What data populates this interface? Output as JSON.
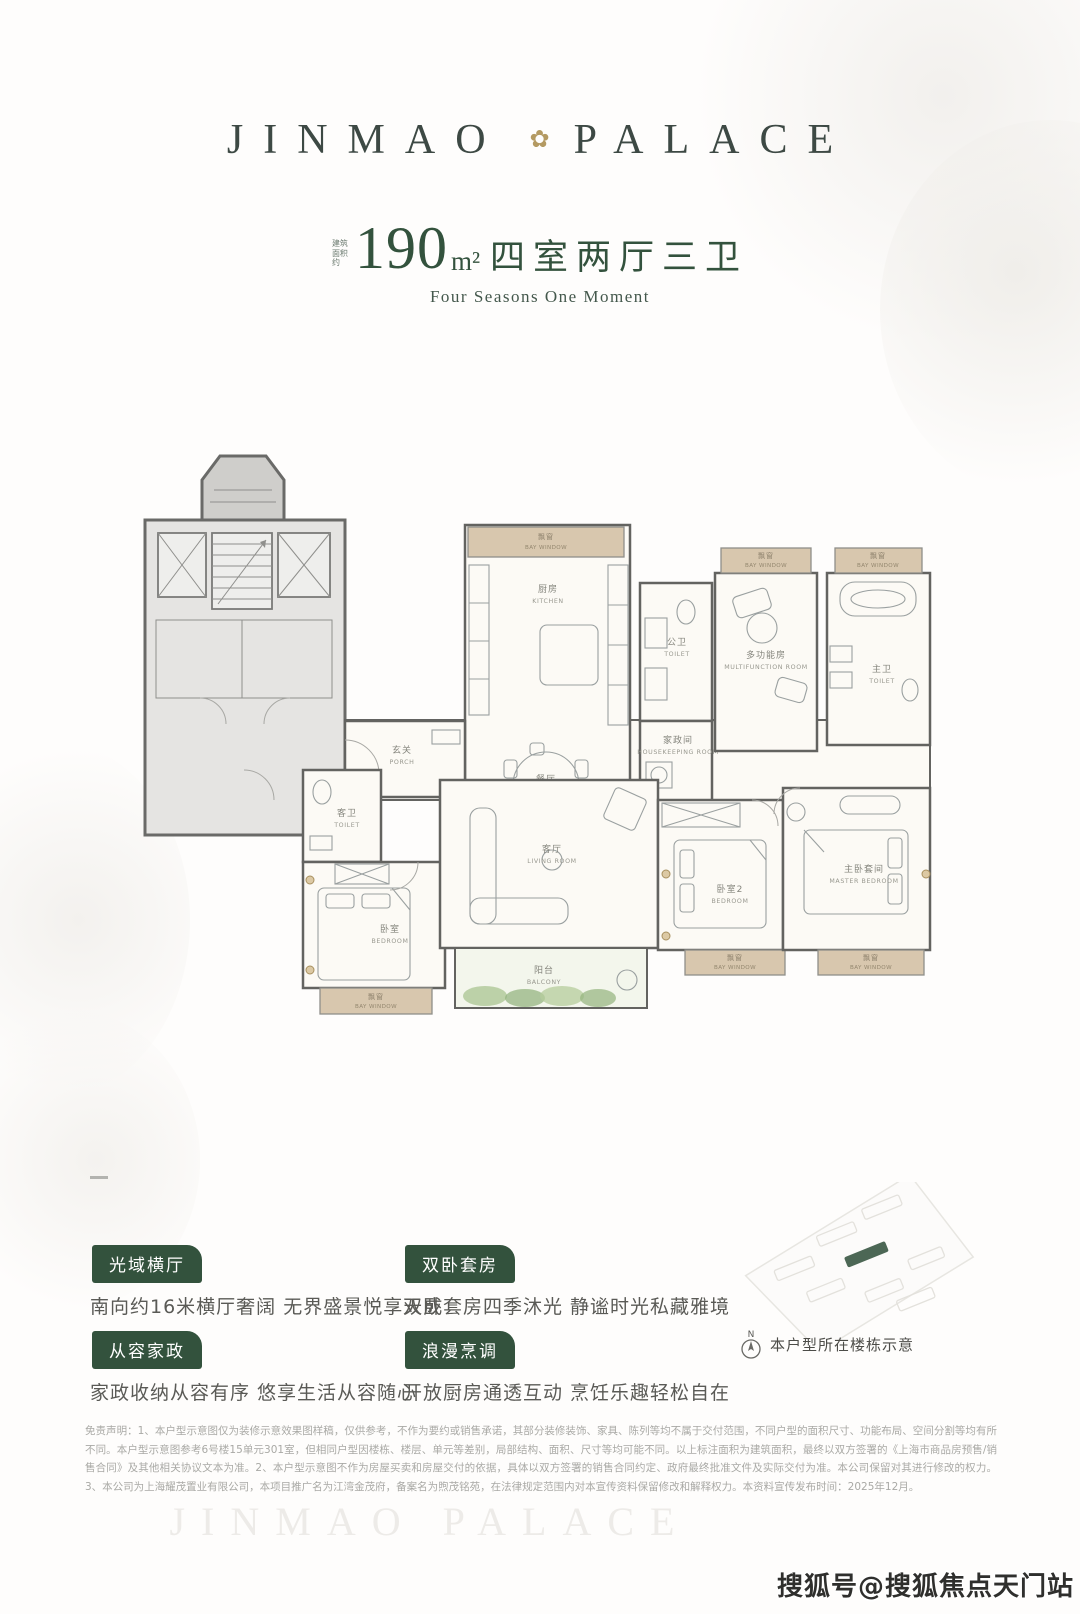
{
  "colors": {
    "accent_green": "#33523d",
    "logo_green": "#3d4944",
    "gold": "#b49a62",
    "bay_tan": "#d8c7ae"
  },
  "logo": {
    "left": "JINMAO",
    "right": "PALACE",
    "emblem_icon": "✿"
  },
  "title": {
    "area_prefix": "建筑面积约",
    "area_number": "190",
    "area_unit": "m²",
    "layout_text": "四室两厅三卫",
    "subtitle": "Four Seasons One Moment"
  },
  "floorplan": {
    "rooms": {
      "bay_window": {
        "cn": "飘窗",
        "en": "BAY WINDOW"
      },
      "kitchen": {
        "cn": "厨房",
        "en": "KITCHEN"
      },
      "dinner": {
        "cn": "餐厅",
        "en": "DINNER"
      },
      "toilet_public": {
        "cn": "公卫",
        "en": "TOILET"
      },
      "housekeeping": {
        "cn": "家政间",
        "en": "HOUSEKEEPING ROOM"
      },
      "multifunction": {
        "cn": "多功能房",
        "en": "MULTIFUNCTION ROOM"
      },
      "toilet_master": {
        "cn": "主卫",
        "en": "TOILET"
      },
      "porch": {
        "cn": "玄关",
        "en": "PORCH"
      },
      "toilet_guest": {
        "cn": "客卫",
        "en": "TOILET"
      },
      "bedroom1": {
        "cn": "卧室",
        "en": "BEDROOM"
      },
      "living": {
        "cn": "客厅",
        "en": "LIVING ROOM"
      },
      "balcony": {
        "cn": "阳台",
        "en": "BALCONY"
      },
      "bedroom2": {
        "cn": "卧室2",
        "en": "BEDROOM"
      },
      "master_bedroom": {
        "cn": "主卧套间",
        "en": "MASTER BEDROOM"
      }
    }
  },
  "features": [
    {
      "tag": "光域横厅",
      "desc": "南向约16米横厅奢阔 无界盛景悦享天成"
    },
    {
      "tag": "双卧套房",
      "desc": "双卧套房四季沐光 静谧时光私藏雅境"
    },
    {
      "tag": "从容家政",
      "desc": "家政收纳从容有序 悠享生活从容随心"
    },
    {
      "tag": "浪漫烹调",
      "desc": "开放厨房通透互动 烹饪乐趣轻松自在"
    }
  ],
  "locator": {
    "north_label": "N",
    "caption": "本户型所在楼栋示意"
  },
  "disclaimer": "免责声明：1、本户型示意图仅为装修示意效果图样稿，仅供参考，不作为要约或销售承诺，其部分装修装饰、家具、陈列等均不属于交付范围，不同户型的面积尺寸、功能布局、空间分割等均有所不同。本户型示意图参考6号楼15单元301室，但相同户型因楼栋、楼层、单元等差别，局部结构、面积、尺寸等均可能不同。以上标注面积为建筑面积，最终以双方签署的《上海市商品房预售/销售合同》及其他相关协议文本为准。2、本户型示意图不作为房屋买卖和房屋交付的依据，具体以双方签署的销售合同约定、政府最终批准文件及实际交付为准。本公司保留对其进行修改的权力。3、本公司为上海耀茂置业有限公司，本项目推广名为江湾金茂府，备案名为煦茂铭苑，在法律规定范围内对本宣传资料保留修改和解释权力。本资料宣传发布时间：2025年12月。",
  "watermarks": {
    "brand": "JINMAO PALACE",
    "credit": "搜狐号@搜狐焦点天门站"
  }
}
